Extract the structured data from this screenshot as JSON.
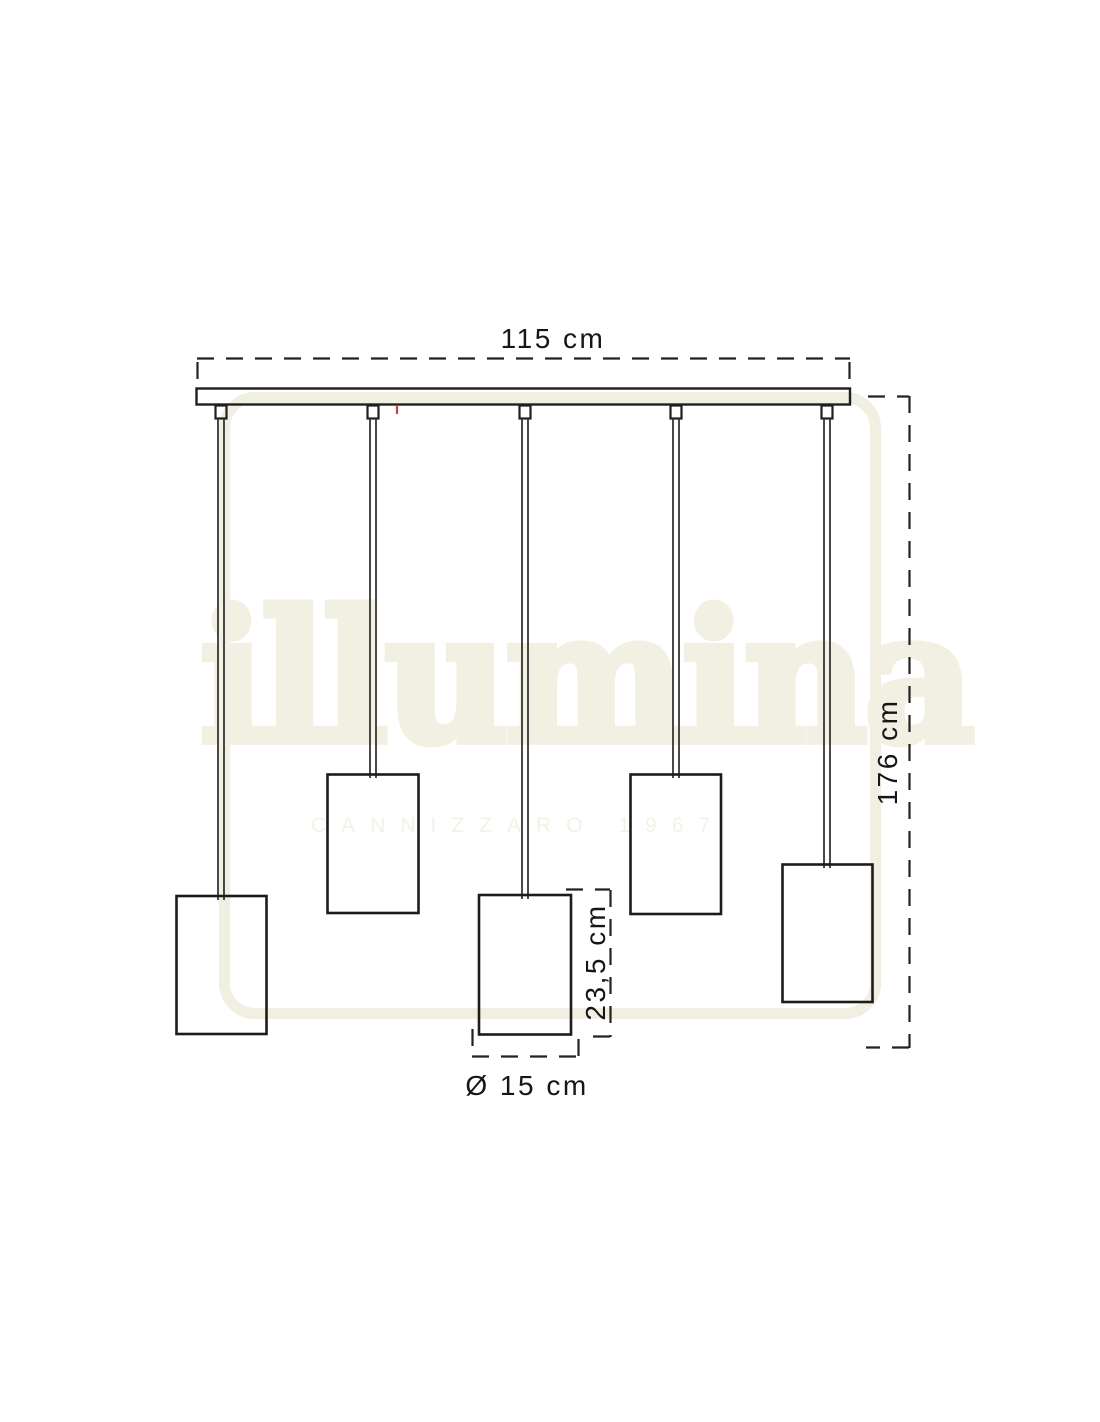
{
  "diagram": {
    "pendant_count": 5
  },
  "dimensions": {
    "bar_width": "115 cm",
    "overall_height": "176 cm",
    "shade_height": "23,5 cm",
    "shade_diameter": "Ø 15 cm"
  },
  "watermark": {
    "brand": "illumina",
    "subtitle": "CANNIZZARO 1967"
  },
  "colors": {
    "background": "#ffffff",
    "line": "#1f1f1f",
    "label_text": "#161616",
    "watermark_beige": "#f1eee2",
    "red_mark": "#c0424e"
  }
}
